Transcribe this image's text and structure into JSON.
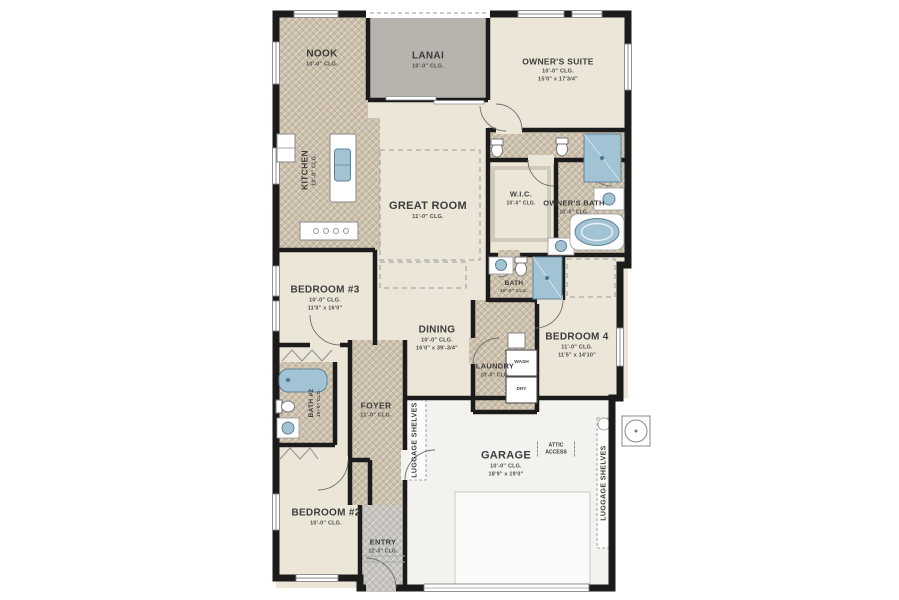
{
  "title": "Residential floor plan",
  "colors": {
    "page_bg": "#ffffff",
    "wall": "#1b1b1b",
    "floor_cream": "#ece6d8",
    "floor_tile": "#cbbfaa",
    "floor_lanai": "#b7b4ad",
    "floor_entry": "#c7c4be",
    "floor_garage": "#f3f2ef",
    "fixture_blue": "#a2c3d4",
    "fixture_blue_edge": "#5d8396",
    "label_text": "#3c3c3c"
  },
  "plan": {
    "rooms": {
      "nook": {
        "name": "NOOK",
        "clg": "10'-0\" CLG."
      },
      "lanai": {
        "name": "LANAI",
        "clg": "10'-0\" CLG."
      },
      "owners_suite": {
        "name": "OWNER'S SUITE",
        "clg": "10'-0\" CLG.",
        "dims": "15'0\" x 17'3/4\""
      },
      "kitchen": {
        "name": "KITCHEN",
        "clg": "10'-0\" CLG."
      },
      "great_room": {
        "name": "GREAT ROOM",
        "clg": "11'-0\" CLG."
      },
      "wic": {
        "name": "W.I.C.",
        "clg": "10'-0\" CLG."
      },
      "owners_bath": {
        "name": "OWNER'S BATH",
        "clg": "10'-0\" CLG."
      },
      "bedroom3": {
        "name": "BEDROOM #3",
        "clg": "10'-0\" CLG.",
        "dims": "11'0\" x 16'0\""
      },
      "dining": {
        "name": "DINING",
        "clg": "10'-0\" CLG.",
        "dims": "16'0\" x 39'-3/4\""
      },
      "bath": {
        "name": "BATH",
        "clg": "10'-0\" CLG."
      },
      "bedroom4": {
        "name": "BEDROOM 4",
        "clg": "11'-0\" CLG.",
        "dims": "11'5\" x 14'10\""
      },
      "laundry": {
        "name": "LAUNDRY",
        "clg": "10'-0\" CLG."
      },
      "bath2": {
        "name": "BATH #2",
        "clg": "10'-0\" CLG."
      },
      "foyer": {
        "name": "FOYER",
        "clg": "11'-0\" CLG."
      },
      "garage": {
        "name": "GARAGE",
        "clg": "10'-0\" CLG.",
        "dims": "18'9\" x 19'0\""
      },
      "bedroom2": {
        "name": "BEDROOM #2",
        "clg": "10'-0\" CLG."
      },
      "entry": {
        "name": "ENTRY",
        "clg": "12'-0\" CLG."
      }
    },
    "features": {
      "luggage_shelves_left": "LUGGAGE SHELVES",
      "luggage_shelves_right": "LUGGAGE SHELVES",
      "attic_access": "ATTIC ACCESS",
      "washer": "WASH",
      "dryer": "DRY"
    }
  }
}
